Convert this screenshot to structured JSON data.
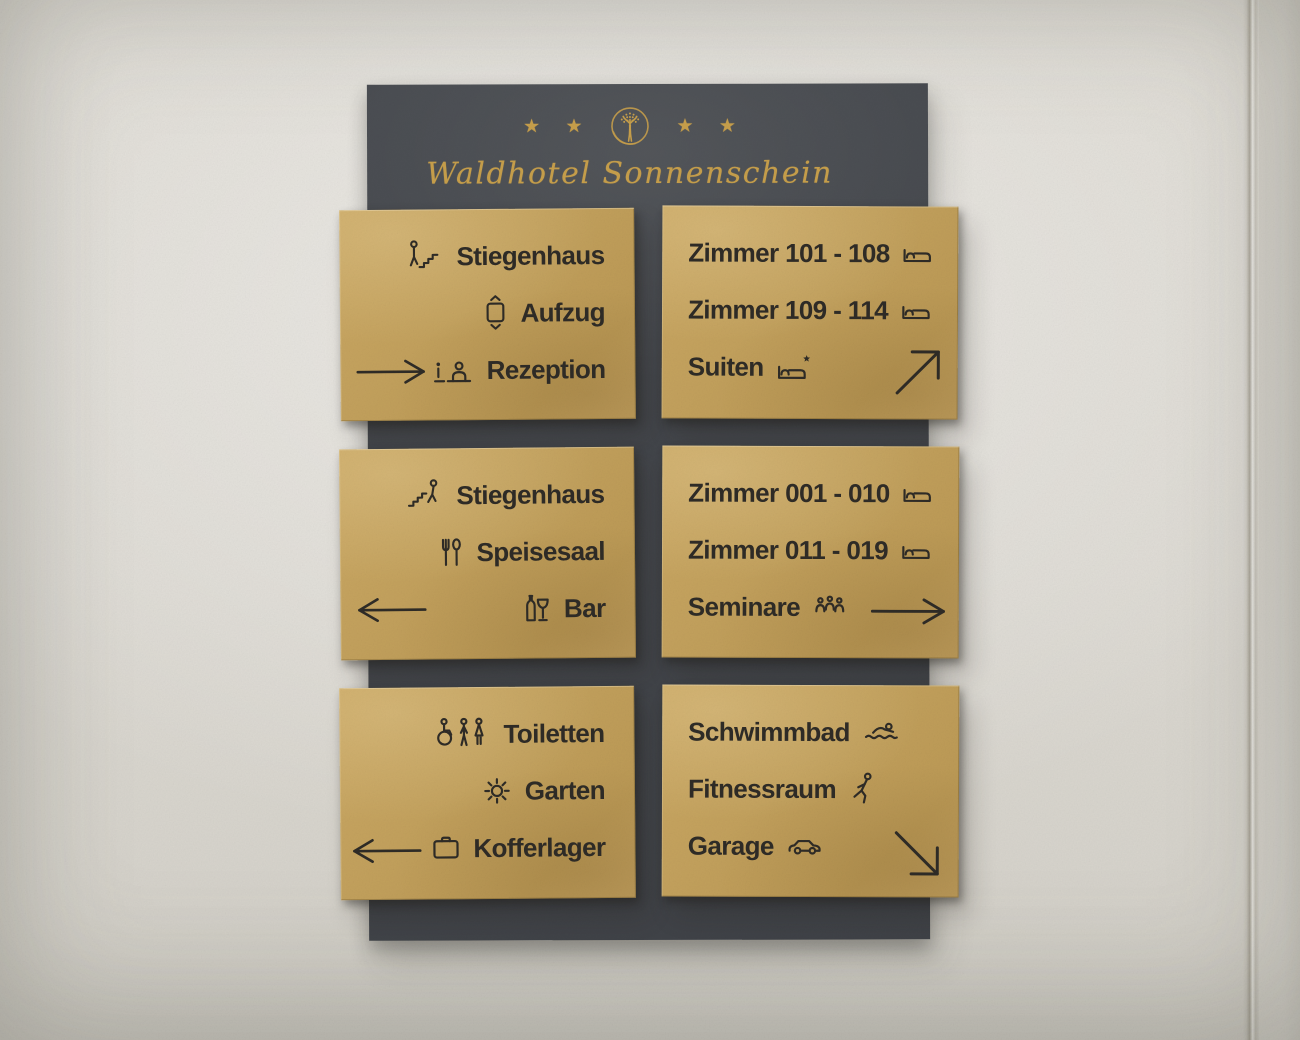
{
  "scene": {
    "description": "Hotel wayfinding signage: six engraved brass plates on a dark board mounted on a concrete wall"
  },
  "header": {
    "stars_left": "★ ★",
    "stars_right": "★ ★",
    "logo_icon": "tree-in-circle",
    "hotel_name": "Waldhotel Sonnenschein"
  },
  "panels": [
    {
      "id": "directory-upper-left",
      "align": "right",
      "rows": [
        {
          "label": "Stiegenhaus",
          "icon": "stairs-up-icon"
        },
        {
          "label": "Aufzug",
          "icon": "elevator-icon"
        },
        {
          "label": "Rezeption",
          "icon": "reception-desk-icon"
        }
      ],
      "arrow": {
        "direction": "right",
        "icon": "arrow-right-icon",
        "position": "bottom-left"
      }
    },
    {
      "id": "directory-upper-right",
      "align": "left",
      "rows": [
        {
          "label": "Zimmer 101 - 108",
          "icon": "bed-icon"
        },
        {
          "label": "Zimmer 109 - 114",
          "icon": "bed-icon"
        },
        {
          "label": "Suiten",
          "icon": "suite-bed-star-icon"
        }
      ],
      "arrow": {
        "direction": "up-right",
        "icon": "arrow-up-right-icon",
        "position": "bottom-right"
      }
    },
    {
      "id": "directory-middle-left",
      "align": "right",
      "rows": [
        {
          "label": "Stiegenhaus",
          "icon": "stairs-down-icon"
        },
        {
          "label": "Speisesaal",
          "icon": "cutlery-icon"
        },
        {
          "label": "Bar",
          "icon": "bottle-glass-icon"
        }
      ],
      "arrow": {
        "direction": "left",
        "icon": "arrow-left-icon",
        "position": "bottom-left"
      }
    },
    {
      "id": "directory-middle-right",
      "align": "left",
      "rows": [
        {
          "label": "Zimmer 001 - 010",
          "icon": "bed-icon"
        },
        {
          "label": "Zimmer 011 - 019",
          "icon": "bed-icon"
        },
        {
          "label": "Seminare",
          "icon": "audience-group-icon"
        }
      ],
      "arrow": {
        "direction": "right",
        "icon": "arrow-right-icon",
        "position": "bottom-right"
      }
    },
    {
      "id": "directory-lower-left",
      "align": "right",
      "rows": [
        {
          "label": "Toiletten",
          "icon": "toilets-icon"
        },
        {
          "label": "Garten",
          "icon": "sun-icon"
        },
        {
          "label": "Kofferlager",
          "icon": "suitcase-icon"
        }
      ],
      "arrow": {
        "direction": "left",
        "icon": "arrow-left-icon",
        "position": "bottom-left"
      }
    },
    {
      "id": "directory-lower-right",
      "align": "left",
      "rows": [
        {
          "label": "Schwimmbad",
          "icon": "swimmer-icon"
        },
        {
          "label": "Fitnessraum",
          "icon": "fitness-icon"
        },
        {
          "label": "Garage",
          "icon": "car-icon"
        }
      ],
      "arrow": {
        "direction": "down-right",
        "icon": "arrow-down-right-icon",
        "position": "bottom-right"
      }
    }
  ],
  "colors": {
    "wall": "#dcd9d2",
    "board": "#45484d",
    "plate_gold": "#c2a05c",
    "engraving": "#2e2b26",
    "brand_gold": "#c79f4b"
  }
}
